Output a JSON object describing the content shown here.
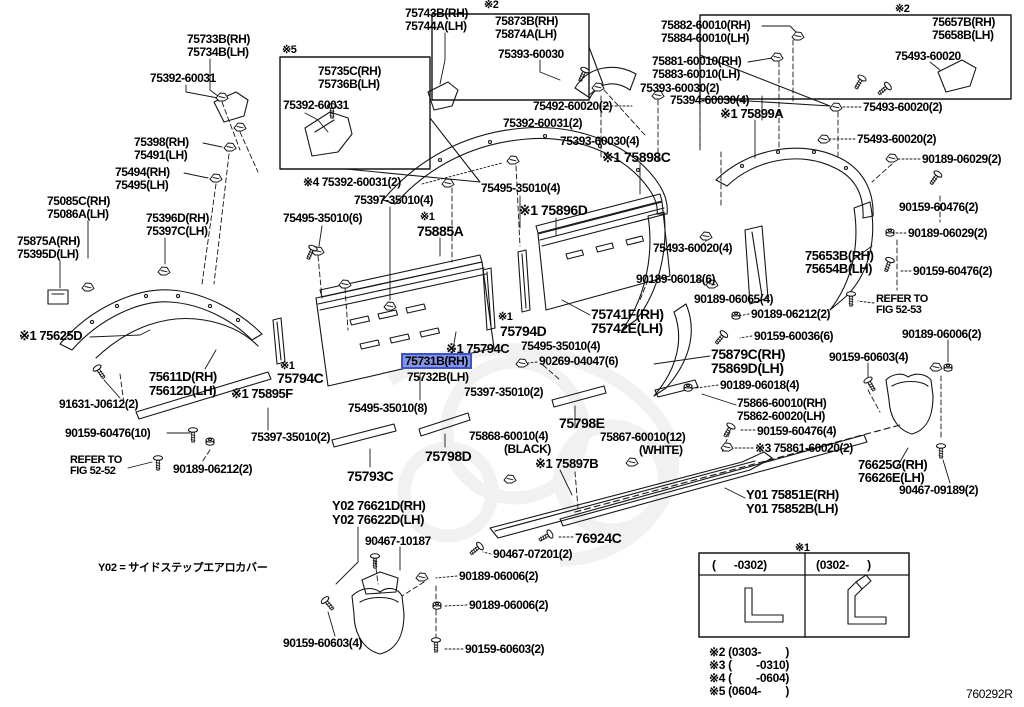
{
  "diagram": {
    "figure_code": "760292R",
    "note_y02": "Y02 = サイドステップエアロカバー",
    "highlight_fill": "#8593e6",
    "highlight_border": "#3d53cc",
    "line_color": "#151515",
    "highlighted_part": "75731B(RH)"
  },
  "legend": {
    "table": {
      "marker": "※1",
      "columns": [
        "(      -0302)",
        "(0302-      )"
      ]
    },
    "notes": [
      "※2 (0303-        )",
      "※3 (        -0310)",
      "※4 (        -0604)",
      "※5 (0604-        )"
    ]
  },
  "labels": [
    {
      "t": "75733B(RH)",
      "x": 187,
      "y": 33
    },
    {
      "t": "75734B(LH)",
      "x": 187,
      "y": 46
    },
    {
      "t": "75392-60031",
      "x": 150,
      "y": 72
    },
    {
      "t": "※5",
      "x": 282,
      "y": 45,
      "s": 11,
      "i": 0
    },
    {
      "t": "75735C(RH)",
      "x": 318,
      "y": 65
    },
    {
      "t": "75736B(LH)",
      "x": 318,
      "y": 78
    },
    {
      "t": "75392-60031",
      "x": 283,
      "y": 99
    },
    {
      "t": "75743B(RH)",
      "x": 405,
      "y": 7
    },
    {
      "t": "75744A(LH)",
      "x": 405,
      "y": 20
    },
    {
      "t": "※2",
      "x": 484,
      "y": 0,
      "s": 11,
      "i": 0
    },
    {
      "t": "75873B(RH)",
      "x": 495,
      "y": 15
    },
    {
      "t": "75874A(LH)",
      "x": 495,
      "y": 28
    },
    {
      "t": "75393-60030",
      "x": 498,
      "y": 48
    },
    {
      "t": "75492-60020(2)",
      "x": 533,
      "y": 100
    },
    {
      "t": "75392-60031(2)",
      "x": 503,
      "y": 117
    },
    {
      "t": "75393-60030(4)",
      "x": 560,
      "y": 135
    },
    {
      "t": "75882-60010(RH)",
      "x": 661,
      "y": 19
    },
    {
      "t": "75884-60010(LH)",
      "x": 661,
      "y": 32
    },
    {
      "t": "75881-60010(RH)",
      "x": 652,
      "y": 55
    },
    {
      "t": "75883-60010(LH)",
      "x": 652,
      "y": 68
    },
    {
      "t": "75393-60030(2)",
      "x": 640,
      "y": 82
    },
    {
      "t": "75394-60030(4)",
      "x": 670,
      "y": 94
    },
    {
      "t": "※1 75899A",
      "x": 720,
      "y": 107,
      "s": 13
    },
    {
      "t": "※2",
      "x": 895,
      "y": 4,
      "s": 11,
      "i": 0
    },
    {
      "t": "75657B(RH)",
      "x": 932,
      "y": 16
    },
    {
      "t": "75658B(LH)",
      "x": 932,
      "y": 29
    },
    {
      "t": "75493-60020",
      "x": 895,
      "y": 50
    },
    {
      "t": "75493-60020(2)",
      "x": 863,
      "y": 101
    },
    {
      "t": "75493-60020(2)",
      "x": 857,
      "y": 133
    },
    {
      "t": "90189-06029(2)",
      "x": 922,
      "y": 153
    },
    {
      "t": "90159-60476(2)",
      "x": 899,
      "y": 201
    },
    {
      "t": "90189-06029(2)",
      "x": 908,
      "y": 227
    },
    {
      "t": "90159-60476(2)",
      "x": 913,
      "y": 265
    },
    {
      "t": "75398(RH)",
      "x": 134,
      "y": 136
    },
    {
      "t": "75491(LH)",
      "x": 134,
      "y": 149
    },
    {
      "t": "75494(RH)",
      "x": 115,
      "y": 166
    },
    {
      "t": "75495(LH)",
      "x": 115,
      "y": 179
    },
    {
      "t": "75085C(RH)",
      "x": 47,
      "y": 195
    },
    {
      "t": "75086A(LH)",
      "x": 47,
      "y": 208
    },
    {
      "t": "75396D(RH)",
      "x": 146,
      "y": 212
    },
    {
      "t": "75397C(LH)",
      "x": 146,
      "y": 225
    },
    {
      "t": "75875A(RH)",
      "x": 17,
      "y": 235
    },
    {
      "t": "75395D(LH)",
      "x": 17,
      "y": 248
    },
    {
      "t": "※4 75392-60031(2)",
      "x": 303,
      "y": 176
    },
    {
      "t": "75397-35010(4)",
      "x": 354,
      "y": 194
    },
    {
      "t": "75495-35010(6)",
      "x": 283,
      "y": 212
    },
    {
      "t": "※1",
      "x": 420,
      "y": 212,
      "s": 11,
      "i": 0
    },
    {
      "t": "75885A",
      "x": 417,
      "y": 224,
      "s": 14
    },
    {
      "t": "75495-35010(4)",
      "x": 481,
      "y": 182
    },
    {
      "t": "※1 75896D",
      "x": 519,
      "y": 203,
      "s": 14
    },
    {
      "t": "※1 75898C",
      "x": 602,
      "y": 150,
      "s": 14
    },
    {
      "t": "75653B(RH)",
      "x": 805,
      "y": 249,
      "s": 13
    },
    {
      "t": "75654B(LH)",
      "x": 805,
      "y": 262,
      "s": 13
    },
    {
      "t": "REFER TO",
      "x": 876,
      "y": 294,
      "s": 11,
      "i": 0
    },
    {
      "t": "FIG 52-53",
      "x": 876,
      "y": 305,
      "s": 11,
      "i": 0
    },
    {
      "t": "75493-60020(4)",
      "x": 653,
      "y": 242
    },
    {
      "t": "90189-06018(6)",
      "x": 636,
      "y": 273
    },
    {
      "t": "90189-06065(4)",
      "x": 694,
      "y": 293
    },
    {
      "t": "90189-06212(2)",
      "x": 751,
      "y": 308
    },
    {
      "t": "90159-60036(6)",
      "x": 754,
      "y": 330
    },
    {
      "t": "75741F(RH)",
      "x": 591,
      "y": 307,
      "s": 14
    },
    {
      "t": "75742E(LH)",
      "x": 591,
      "y": 321,
      "s": 14
    },
    {
      "t": "※1",
      "x": 498,
      "y": 312,
      "s": 11,
      "i": 0
    },
    {
      "t": "75794D",
      "x": 500,
      "y": 324,
      "s": 14
    },
    {
      "t": "※1 75794C",
      "x": 446,
      "y": 342,
      "s": 13
    },
    {
      "t": "75495-35010(4)",
      "x": 521,
      "y": 340
    },
    {
      "t": "90269-04047(6)",
      "x": 539,
      "y": 355
    },
    {
      "t": "75879C(RH)",
      "x": 711,
      "y": 347,
      "s": 14
    },
    {
      "t": "75869D(LH)",
      "x": 711,
      "y": 361,
      "s": 14
    },
    {
      "t": "90189-06018(4)",
      "x": 720,
      "y": 379
    },
    {
      "t": "75866-60010(RH)",
      "x": 737,
      "y": 397
    },
    {
      "t": "75862-60020(LH)",
      "x": 737,
      "y": 410
    },
    {
      "t": "90159-60476(4)",
      "x": 757,
      "y": 425
    },
    {
      "t": "※3 75861-60020(2)",
      "x": 755,
      "y": 442
    },
    {
      "t": "90189-06006(2)",
      "x": 902,
      "y": 328
    },
    {
      "t": "90159-60603(4)",
      "x": 829,
      "y": 351
    },
    {
      "t": "※1 75625D",
      "x": 19,
      "y": 329,
      "s": 13
    },
    {
      "t": "75611D(RH)",
      "x": 149,
      "y": 370,
      "s": 13
    },
    {
      "t": "75612D(LH)",
      "x": 149,
      "y": 384,
      "s": 13
    },
    {
      "t": "※1",
      "x": 280,
      "y": 361,
      "s": 11,
      "i": 0
    },
    {
      "t": "75794C",
      "x": 277,
      "y": 371,
      "s": 14
    },
    {
      "t": "※1 75895F",
      "x": 231,
      "y": 387,
      "s": 13
    },
    {
      "t": "75731B(RH)",
      "x": 406,
      "y": 356,
      "h": 1
    },
    {
      "t": "75732B(LH)",
      "x": 407,
      "y": 371
    },
    {
      "t": "75397-35010(2)",
      "x": 464,
      "y": 386
    },
    {
      "t": "75495-35010(8)",
      "x": 348,
      "y": 402
    },
    {
      "t": "91631-J0612(2)",
      "x": 59,
      "y": 398
    },
    {
      "t": "90159-60476(10)",
      "x": 65,
      "y": 427
    },
    {
      "t": "REFER TO",
      "x": 70,
      "y": 455,
      "s": 11,
      "i": 0
    },
    {
      "t": "FIG 52-52",
      "x": 70,
      "y": 466,
      "s": 11,
      "i": 0
    },
    {
      "t": "90189-06212(2)",
      "x": 173,
      "y": 463
    },
    {
      "t": "75397-35010(2)",
      "x": 251,
      "y": 431
    },
    {
      "t": "75793C",
      "x": 347,
      "y": 469,
      "s": 14
    },
    {
      "t": "75798D",
      "x": 425,
      "y": 449,
      "s": 14
    },
    {
      "t": "75868-60010(4)",
      "x": 469,
      "y": 430
    },
    {
      "t": "(BLACK)",
      "x": 504,
      "y": 443
    },
    {
      "t": "75798E",
      "x": 559,
      "y": 416,
      "s": 14
    },
    {
      "t": "75867-60010(12)",
      "x": 600,
      "y": 431
    },
    {
      "t": "(WHITE)",
      "x": 639,
      "y": 444
    },
    {
      "t": "※1 75897B",
      "x": 535,
      "y": 457,
      "s": 13
    },
    {
      "t": "Y01 75851E(RH)",
      "x": 746,
      "y": 488,
      "s": 13
    },
    {
      "t": "Y01 75852B(LH)",
      "x": 746,
      "y": 502,
      "s": 13
    },
    {
      "t": "76924C",
      "x": 575,
      "y": 531,
      "s": 14
    },
    {
      "t": "90467-07201(2)",
      "x": 493,
      "y": 548
    },
    {
      "t": "Y02 76621D(RH)",
      "x": 332,
      "y": 499,
      "s": 13
    },
    {
      "t": "Y02 76622D(LH)",
      "x": 332,
      "y": 513,
      "s": 13
    },
    {
      "t": "90467-10187",
      "x": 365,
      "y": 535
    },
    {
      "t": "90189-06006(2)",
      "x": 459,
      "y": 570
    },
    {
      "t": "90189-06006(2)",
      "x": 469,
      "y": 599
    },
    {
      "t": "90159-60603(4)",
      "x": 283,
      "y": 637
    },
    {
      "t": "90159-60603(2)",
      "x": 465,
      "y": 643
    },
    {
      "t": "76625G(RH)",
      "x": 858,
      "y": 458,
      "s": 13
    },
    {
      "t": "76626E(LH)",
      "x": 858,
      "y": 471,
      "s": 13
    },
    {
      "t": "90467-09189(2)",
      "x": 899,
      "y": 484
    }
  ]
}
